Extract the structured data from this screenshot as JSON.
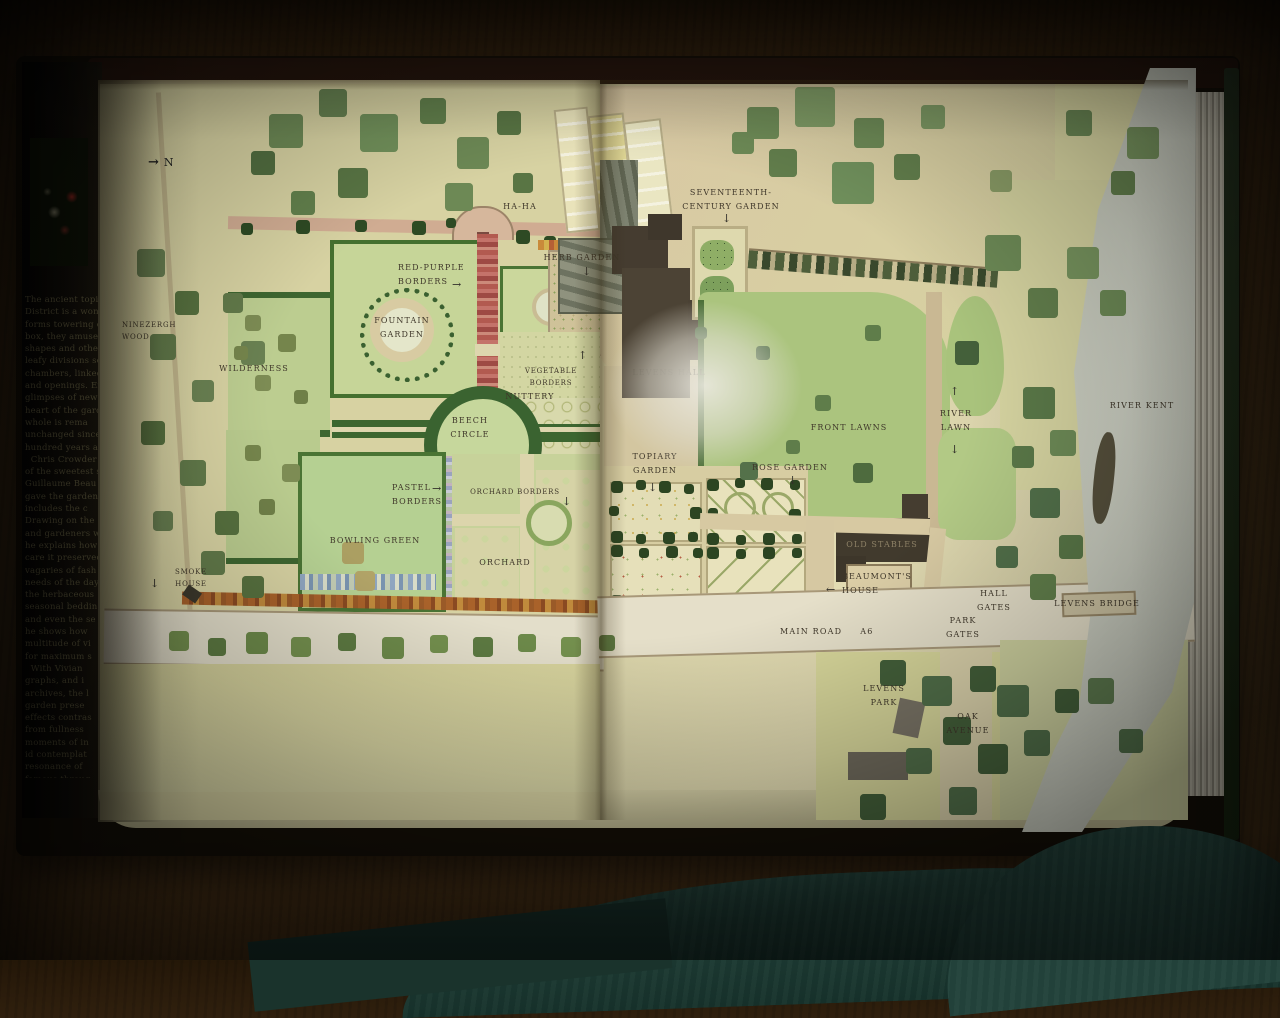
{
  "scene": {
    "description": "Photograph of an open book showing a watercolour plan of the gardens and park at Levens Hall beside the River Kent",
    "north_indicator": "N"
  },
  "flap": {
    "text": "The ancient topiar\nDistrict is a wonde\nforms towering ov\nbox, they amuse\nshapes and otherw\nleafy divisions se\nchambers, linked\nand openings. En\nglimpses of new\nheart of the garde\nwhole is rema\nunchanged since\nhundred years ag\n  Chris Crowder\nof the sweetest s\nGuillaume Beau\ngave the garden\nincludes the c\nDrawing on the\nand gardeners w\nhe explains how\ncare it preserved\nvagaries of fash\nneeds of the day\nthe herbaceous\nseasonal beddin\nand even the se\nhe shows how\nmultitude of vi\nfor maximum s\n  With Vivian\ngraphs, and i\narchives, the l\ngarden prese\neffects contras\nfrom fullness\nmoments of in\nid contemplat\nresonance of\nfamous throug"
  },
  "map": {
    "labels": {
      "ha_ha": "HA-HA",
      "seventeenth_century_garden": "SEVENTEENTH-\nCENTURY GARDEN",
      "herb_garden": "HERB GARDEN",
      "red_purple_borders": "RED-PURPLE\nBORDERS",
      "fountain_garden": "FOUNTAIN\nGARDEN",
      "ninezergh_wood": "NINEZERGH\nWOOD",
      "wilderness": "WILDERNESS",
      "vegetable_borders": "VEGETABLE BORDERS",
      "nuttery": "NUTTERY",
      "beech_circle": "BEECH\nCIRCLE",
      "levens_hall": "LEVENS HALL",
      "front_lawns": "FRONT LAWNS",
      "river_lawn": "RIVER\nLAWN",
      "river_kent": "RIVER KENT",
      "topiary_garden": "TOPIARY\nGARDEN",
      "rose_garden": "ROSE GARDEN",
      "pastel_borders": "PASTEL\nBORDERS",
      "orchard_borders": "ORCHARD BORDERS",
      "bowling_green": "BOWLING GREEN",
      "orchard": "ORCHARD",
      "smoke_house": "SMOKE HOUSE",
      "old_stables": "OLD STABLES",
      "beaumonts_house": "BEAUMONT'S\nHOUSE",
      "hall_gates": "HALL\nGATES",
      "levens_bridge": "LEVENS BRIDGE",
      "main_road": "MAIN ROAD",
      "main_road_number": "A6",
      "park_gates": "PARK\nGATES",
      "levens_park": "LEVENS\nPARK",
      "oak_avenue": "OAK\nAVENUE"
    },
    "icons": {
      "north_arrow": "→",
      "down_arrow": "↓",
      "up_arrow": "↑",
      "right_arrow": "→",
      "left_arrow": "←"
    },
    "colors": {
      "lawn": "#b7cc8e",
      "hedge": "#3e6630",
      "river": "#c2c5b8",
      "path": "#ddd2ac",
      "building": "#4a4236",
      "label": "#3f372a"
    }
  }
}
